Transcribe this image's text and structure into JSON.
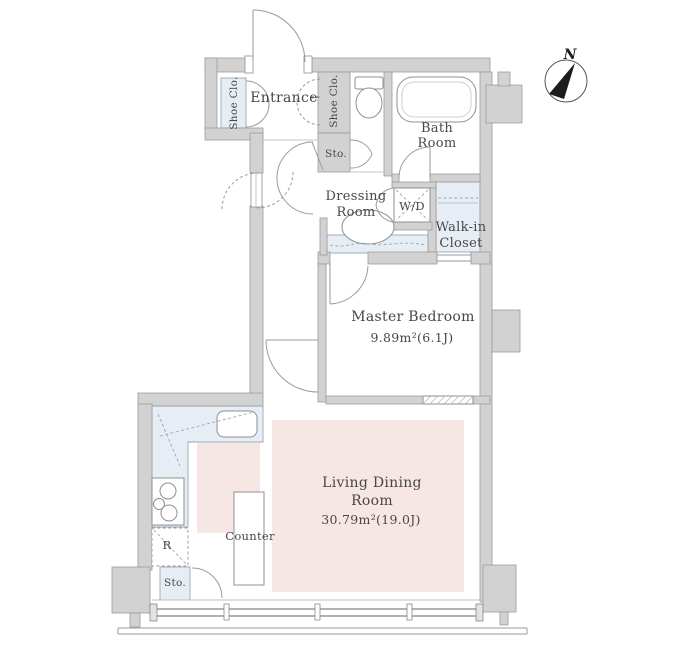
{
  "compass": {
    "north_label": "N"
  },
  "rooms": {
    "entrance": {
      "label": "Entrance"
    },
    "shoe_closet_left": {
      "label": "Shoe Clo."
    },
    "shoe_closet_right": {
      "label": "Shoe Clo."
    },
    "hall_storage": {
      "label": "Sto."
    },
    "bath": {
      "label": [
        "Bath",
        "Room"
      ]
    },
    "dressing": {
      "label": [
        "Dressing",
        "Room"
      ]
    },
    "washer_dryer": {
      "label": "W/D"
    },
    "walk_in_closet": {
      "label": [
        "Walk-in",
        "Closet"
      ]
    },
    "master_bedroom": {
      "label": "Master Bedroom",
      "area": "9.89m²(6.1J)"
    },
    "living_dining": {
      "label": [
        "Living Dining",
        "Room"
      ],
      "area": "30.79m²(19.0J)"
    },
    "kitchen": {
      "counter": "Counter",
      "refrigerator": "R",
      "storage": "Sto."
    }
  },
  "colors": {
    "wall": "#d2d2d2",
    "wall_outline": "#9c9c9c",
    "fixture_blue": "#e7edf4",
    "fixture_border": "#9aa7b4",
    "floor_pink": "#f7e7e4",
    "line": "#8f8f8f",
    "text": "#474747"
  }
}
